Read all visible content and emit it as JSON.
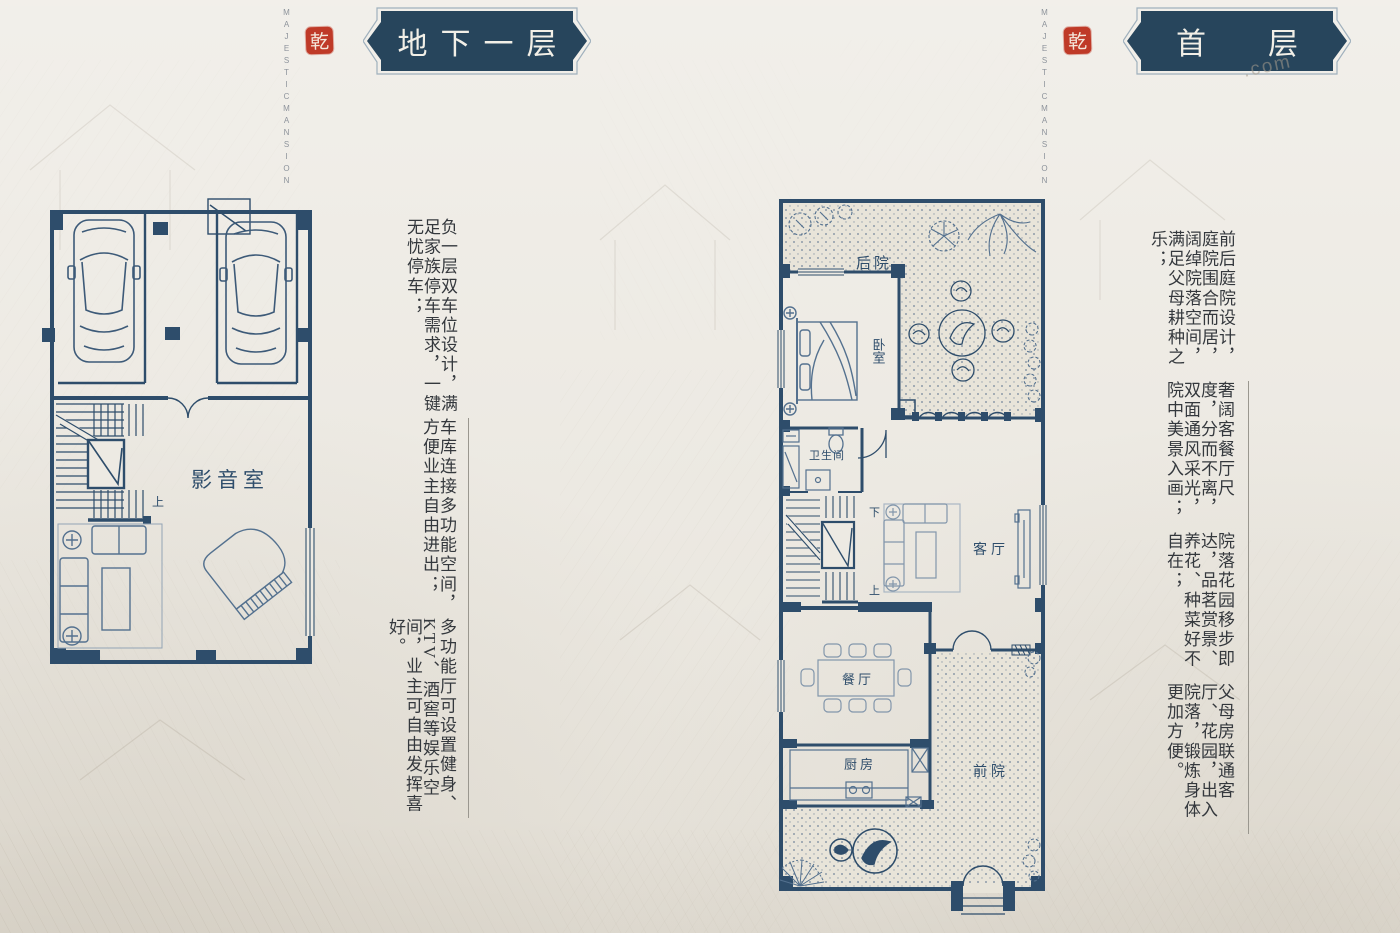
{
  "colors": {
    "paper": "#edeae3",
    "plan_line": "#2e4d6b",
    "banner_bg": "#27455c",
    "seal_red": "#bf3a28",
    "furniture": "#54718f"
  },
  "brand": {
    "word_right": "MAJESTIC",
    "word_left": "MANSION",
    "seal_char": "乾"
  },
  "watermark": ".com",
  "basement": {
    "banner_title": "地下一层",
    "rooms": {
      "media_room": "影音室"
    },
    "stairs": {
      "up": "上"
    },
    "descriptions": [
      "负一层双车位设计，满足家族停车需求，一键无忧停车；",
      "车库连接多功能空间，方便业主自由进出；",
      "多功能厅可设置健身、KTV、酒窖等娱乐空间，业主可自由发挥喜好。"
    ]
  },
  "first_floor": {
    "banner_chars": [
      "首",
      "层"
    ],
    "rooms": {
      "backyard": "后院",
      "bedroom": "卧室",
      "bathroom": "卫生间",
      "living": "客厅",
      "dining": "餐厅",
      "kitchen": "厨房",
      "frontyard": "前院"
    },
    "stairs": {
      "down": "下",
      "up": "上"
    },
    "descriptions": [
      "前后庭院设计，庭院围合而居，阔绰院落空间，满足父母耕种之乐；",
      "奢阔客餐厅尺度，分而不离，双面通风采光，院中美景入画；",
      "院落花园移步即达，品茗赏景、养花、种菜好不自在；",
      "父母房联通客厅、花园，出入院落，锻炼身体更加方便。"
    ]
  }
}
